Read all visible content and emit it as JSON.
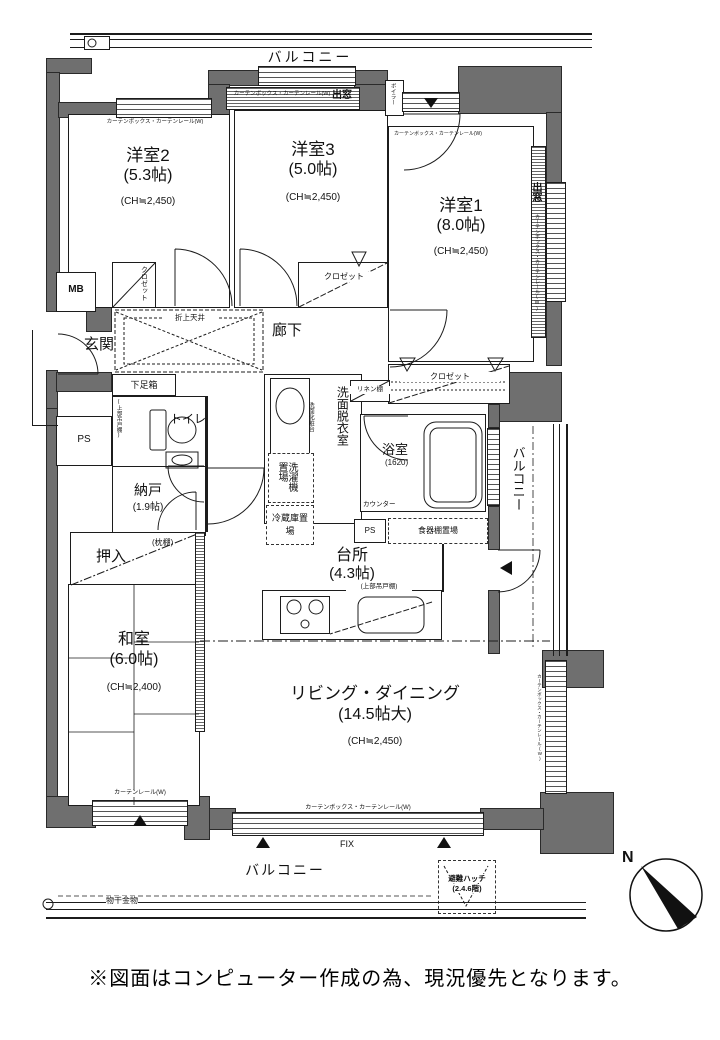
{
  "page": {
    "footnote": "※図面はコンピューター作成の為、現況優先となります。",
    "compass": {
      "north": "N"
    }
  },
  "colors": {
    "wall": "#6f6f6f",
    "line": "#1c1c1c",
    "background": "#ffffff"
  },
  "balconies": {
    "top": "バルコニー",
    "right": "バルコニー",
    "bottom": "バルコニー",
    "monohoshi": "物干金物",
    "hinan_hatch": "避難ハッチ",
    "hinan_hatch_floors": "(2.4.6階)"
  },
  "rooms": {
    "yoshitsu2": {
      "name": "洋室2",
      "size": "(5.3帖)",
      "ch": "(CH≒2,450)"
    },
    "yoshitsu3": {
      "name": "洋室3",
      "size": "(5.0帖)",
      "ch": "(CH≒2,450)"
    },
    "yoshitsu1": {
      "name": "洋室1",
      "size": "(8.0帖)",
      "ch": "(CH≒2,450)"
    },
    "washitsu": {
      "name": "和室",
      "size": "(6.0帖)",
      "ch": "(CH≒2,400)"
    },
    "living": {
      "name": "リビング・ダイニング",
      "size": "(14.5帖大)",
      "ch": "(CH≒2,450)"
    },
    "kitchen": {
      "name": "台所",
      "size": "(4.3帖)"
    },
    "nando": {
      "name": "納戸",
      "size": "(1.9帖)"
    },
    "bath": {
      "name": "浴室",
      "size": "(1620)"
    },
    "genkan": "玄関",
    "rouka": "廊下",
    "toilet": "トイレ",
    "senmen": "洗面脱衣室",
    "oshiire": "押入"
  },
  "fixtures": {
    "mb": "MB",
    "ps_left": "PS",
    "ps_kitchen": "PS",
    "boiler": "ボイラー",
    "getabako": "下足箱",
    "oriage_tenjo": "折上天井",
    "closet_y2": "クロゼット",
    "closet_y3": "クロゼット",
    "closet_y1": "クロゼット",
    "linen_shelf": "リネン棚",
    "senmen_keshodai": "洗面化粧台",
    "washer": "洗濯機置場",
    "fridge": "冷蔵庫置場",
    "counter": "カウンター",
    "cupboard": "食器棚置場",
    "hanging_cupboard_toilet": "(上部吊戸棚)",
    "hanging_cupboard_kitchen": "(上部吊戸棚)",
    "makuradana": "(枕棚)",
    "fix_window": "FIX"
  },
  "windows": {
    "demado_top": "出窓",
    "demado_right": "出窓",
    "curtain_box_y2": "カーテンボックス・カーテンレール(W)",
    "curtain_box_y3": "カーテンボックス・カーテンレール(W)",
    "curtain_box_y1_top": "カーテンボックス・カーテンレール(W)",
    "curtain_box_y1_right": "カーテンボックス・カーテンレール(W)",
    "curtain_box_living_right": "カーテンボックス・カーテンレール(W)",
    "curtain_box_living_bottom": "カーテンボックス・カーテンレール(W)",
    "curtain_rail_washitsu": "カーテンレール(W)"
  }
}
